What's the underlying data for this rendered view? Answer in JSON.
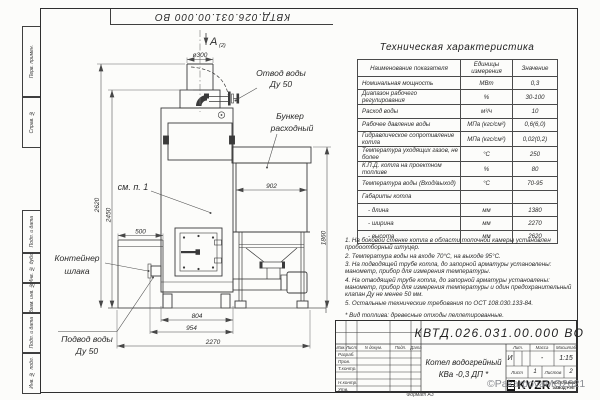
{
  "sheet": {
    "doc_number": "КВТД.026.031.00.000 ВО",
    "format_label": "Формат А3",
    "watermark": "©PakarpovaMG2021"
  },
  "margin_labels": {
    "perv": "Перв. примен.",
    "sprav": "Справ. №",
    "podp1": "Подп. и дата",
    "inv_dubl": "Инв. № дубл.",
    "vzam": "Взам. инв. №",
    "podp2": "Подп. и дата",
    "inv_podl": "Инв. № подл."
  },
  "drawing": {
    "view_label": "А",
    "view_ref": "(2)",
    "see_note": "см. п. 1",
    "callouts": {
      "otvod_1": "Отвод воды",
      "otvod_2": "Ду 50",
      "bunker_1": "Бункер",
      "bunker_2": "расходный",
      "container_1": "Контейнер",
      "container_2": "шлака",
      "podvod_1": "Подвод воды",
      "podvod_2": "Ду 50"
    },
    "dims": {
      "d300": "ø300",
      "w902": "902",
      "h1860": "1860",
      "h2620": "2620",
      "h2450": "2450",
      "w500": "500",
      "w804": "804",
      "w954": "954",
      "w2270": "2270"
    }
  },
  "spec_table": {
    "title": "Техническая характеристика",
    "headers": [
      "Наименование показателя",
      "Единицы измерения",
      "Значение"
    ],
    "rows": [
      [
        "Номинальная мощность",
        "МВт",
        "0,3"
      ],
      [
        "Диапазон рабочего регулирования",
        "%",
        "30-100"
      ],
      [
        "Расход воды",
        "м³/ч",
        "10"
      ],
      [
        "Рабочее давление воды",
        "МПа (кгс/см²)",
        "0,6(6,0)"
      ],
      [
        "Гидравлическое сопротивление котла",
        "МПа (кгс/см²)",
        "0,02(0,2)"
      ],
      [
        "Температура уходящих газов, не более",
        "°С",
        "250"
      ],
      [
        "К.П.Д. котла на проектном топливе",
        "%",
        "80"
      ],
      [
        "Температура воды (Вход/выход)",
        "°С",
        "70-95"
      ],
      [
        "Габариты котла",
        "",
        ""
      ],
      [
        "- длина",
        "мм",
        "1380"
      ],
      [
        "- ширина",
        "мм",
        "2270"
      ],
      [
        "- высота",
        "мм",
        "2620"
      ]
    ]
  },
  "notes": [
    "1. На боковой стенке котла в области топочной камеры установлен пробоотборный штуцер.",
    "2. Температура воды на входе 70°С, на выходе 95°С.",
    "3. На подводящей трубе котла, до запорной арматуры установлены: манометр, прибор для измерения температуры.",
    "4. На отводящей трубе котла, до запорной арматуры установлены: манометр, прибор для измерения температуры и один предохранительный клапан Ду не менее 50 мм.",
    "5. Остальные технические требования по ОСТ 108.030.133-84."
  ],
  "fuel_note": "* Вид топлива: древесные отходы пеллетированные.",
  "title_block": {
    "doc_number": "КВТД.026.031.00.000 ВО",
    "change_cols": [
      "Изм.",
      "Лист",
      "N докум.",
      "Подп.",
      "Дата"
    ],
    "roles": [
      "Разраб.",
      "Пров.",
      "Т.контр.",
      "",
      "Н.контр.",
      "Утв."
    ],
    "product_line1": "Котел водогрейный",
    "product_line2": "КВа -0,3 ДП *",
    "lit_label": "Лит.",
    "lit_value": "И",
    "mass_label": "Масса",
    "mass_value": "-",
    "scale_label": "Масштаб",
    "scale_value": "1:15",
    "sheet_label": "Лист",
    "sheet_value": "1",
    "sheets_label": "Листов",
    "sheets_value": "2",
    "company": "KVZR",
    "company_sub1": "КОТЕЛЬНЫЙ",
    "company_sub2": "ЗАВОД РЭП"
  }
}
